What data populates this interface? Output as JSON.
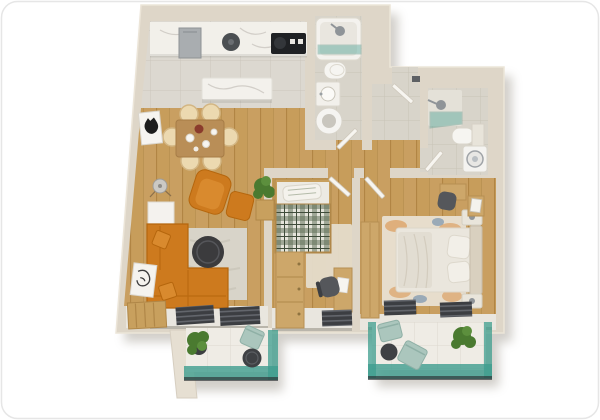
{
  "scene": {
    "type": "3d-floor-plan-top-view",
    "description": "Photorealistic top-down 3D render of a two-bedroom apartment with open kitchen/living area, two bathrooms, entry hall and two balconies",
    "text_labels": [],
    "palette": {
      "wall": "#ded6c8",
      "wall_light": "#ece5d8",
      "shadow": "#a39b8d",
      "wood_floor": "#c99f61",
      "kitchen_tile": "#dcd8d0",
      "bathroom_tile": "#d8d4ca",
      "balcony_tile": "#efece5",
      "glass_teal": "#3e9d8e",
      "sofa_orange": "#cd7a1e",
      "sofa_orange_light": "#d98a2e",
      "counter_marble": "#f2f0ea",
      "table_wood": "#b98e57",
      "chair_wicker": "#ecd9b0",
      "rug_living": "#d8d4c9",
      "rug_bedroom": "#e5dccb",
      "coffee_table": "#3b3b3d",
      "radiator": "#3c3e42",
      "plant_green": "#4a7a30",
      "plaid_green": "#5c6b54",
      "bedding": "#eae6dd",
      "furniture_wood": "#cda76a",
      "appliance_white": "#f4f3f0",
      "fridge_gray": "#a9adb0",
      "stove_black": "#1f2124",
      "chair_teal": "#abc6bd",
      "dark_chair": "#55575b"
    },
    "rooms": [
      {
        "id": "open-living",
        "name": "open-plan kitchen / dining / living room",
        "floor": "tile + wood",
        "furniture": [
          "kitchen counter with marble top",
          "refrigerator",
          "sink",
          "cooktop",
          "kitchen island",
          "dining table",
          "6 wicker dining chairs",
          "tableware",
          "cat art frame",
          "floor lamp",
          "white side cabinet",
          "potted plant",
          "orange armchair",
          "orange ottoman",
          "orange corner sofa",
          "2 throw pillows",
          "round coffee table",
          "area rug",
          "leaning art frame",
          "wood bench",
          "2 radiator grilles"
        ]
      },
      {
        "id": "bathroom-1",
        "name": "bathroom with bathtub",
        "furniture": [
          "bathtub with glass screen",
          "shower head",
          "toilet",
          "washbasin cabinet",
          "washing machine",
          "door"
        ]
      },
      {
        "id": "entry-hall",
        "name": "entry hall",
        "furniture": [
          "entrance door"
        ]
      },
      {
        "id": "bathroom-2",
        "name": "shower bathroom",
        "furniture": [
          "corner shower with glass panel",
          "shower head",
          "toilet with cistern",
          "washing machine",
          "door"
        ]
      },
      {
        "id": "small-bedroom",
        "name": "small bedroom",
        "furniture": [
          "single bed with plaid duvet",
          "pillow",
          "wardrobe dresser",
          "area rug",
          "desk",
          "desk chair",
          "radiator grille",
          "door"
        ]
      },
      {
        "id": "master-bedroom",
        "name": "master bedroom",
        "furniture": [
          "double bed",
          "headboard",
          "2 pillows",
          "2 nightstands",
          "wardrobe",
          "vanity desk",
          "desk chair",
          "side cabinet",
          "colorful area rug",
          "2 radiator grilles",
          "door"
        ]
      },
      {
        "id": "balcony-left",
        "name": "living-room balcony",
        "furniture": [
          "potted plant",
          "bistro chair",
          "round side table",
          "teal glass balustrade"
        ]
      },
      {
        "id": "balcony-right",
        "name": "bedroom balcony",
        "furniture": [
          "2 bistro chairs",
          "round side table",
          "potted plant",
          "teal glass balustrade"
        ]
      }
    ]
  }
}
